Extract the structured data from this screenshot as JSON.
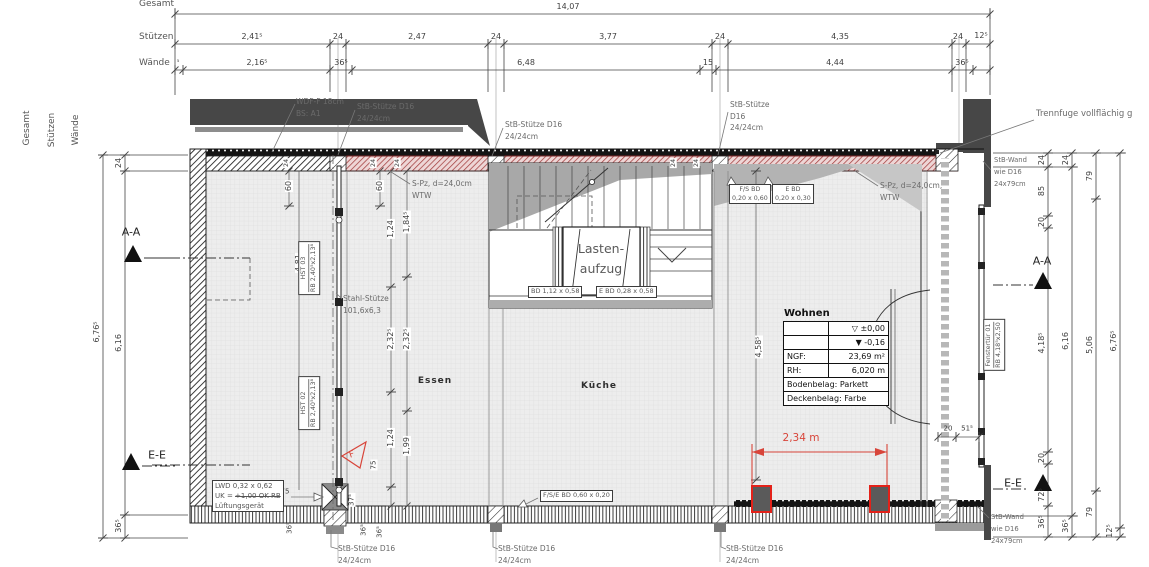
{
  "top_dims": {
    "row_labels": [
      "Gesamt",
      "Stützen",
      "Wände"
    ],
    "total": "14,07",
    "stuetzen": [
      "2,41⁵",
      "24",
      "2,47",
      "24",
      "3,77",
      "24",
      "4,35",
      "24",
      "12⁵"
    ],
    "waende": [
      "⁵",
      "2,16⁵",
      "36⁵",
      "6,48",
      "15",
      "4,44",
      "36⁵"
    ]
  },
  "left_dims": {
    "rotated_labels": [
      "Gesamt",
      "Stützen",
      "Wände"
    ],
    "total": "6,76⁵",
    "inner": [
      "24",
      "6,16",
      "36⁵"
    ],
    "section_aa": "A-A",
    "section_ee": "E-E"
  },
  "right_dims": {
    "chain1": [
      "24",
      "85",
      "20",
      "4,18⁵",
      "20",
      "72⁵",
      "36⁵"
    ],
    "chain2": [
      "24",
      "6,16",
      "36⁵"
    ],
    "chain3": [
      "79",
      "5,06",
      "79"
    ],
    "chain4_total": "6,76⁵",
    "chain4_bottom": "12⁵",
    "section_aa": "A-A",
    "section_ee": "E-E",
    "door_dims": [
      "20",
      "51⁵"
    ]
  },
  "interior_dims": {
    "d60": "60",
    "d124": "1,24",
    "d1845": "1,84⁵",
    "d2325": "2,32⁵",
    "d199": "1,99",
    "d481": "4,81",
    "d4585": "4,58⁵",
    "d75": "75",
    "d375": "37⁵",
    "d365": "36⁵",
    "d24": "24"
  },
  "rooms": {
    "essen": "Essen",
    "kueche": "Küche",
    "lift_line1": "Lasten-",
    "lift_line2": "aufzug"
  },
  "wohnen_table": {
    "title": "Wohnen",
    "level_upper": "▽ ±0,00",
    "level_lower": "▼ -0,16",
    "ngf_label": "NGF:",
    "ngf_value": "23,69 m²",
    "rh_label": "RH:",
    "rh_value": "6,020 m",
    "floor": "Bodenbelag: Parkett",
    "ceiling": "Deckenbelag: Farbe"
  },
  "annotations": {
    "wdf_1": "WDF-F 18cm",
    "wdf_2": "BS: A1",
    "stb_stuetze": "StB-Stütze D16",
    "stb_stuetze_a": "StB-Stütze",
    "stb_stuetze_b": "D16",
    "stb_size": "24/24cm",
    "spz": "S-Pz, d=24,0cm",
    "spz_r": "S-Pz, d=24,0cm,",
    "wtw": "WTW",
    "trennfuge": "Trennfuge vollflächig g",
    "stb_wand_1": "StB-Wand",
    "stb_wand_2": "wie D16",
    "stb_wand_3": "24x79cm",
    "fs_bd_1": "F/S BD",
    "fs_bd_2": "0,20 x 0,60",
    "e_bd_1": "E BD",
    "e_bd_2": "0,20 x 0,30",
    "bd_1": "BD 1,12 x 0,58",
    "bd_2": "E BD 0,28 x 0,58",
    "stahl_1": "Stahl-Stütze",
    "stahl_2": "101,6x6,3",
    "hst03": "HST 03",
    "hst02": "HST 02",
    "hst_rb": "RB 2,40⁵x2,13⁸",
    "lwd_1": "LWD 0,32 x 0,62",
    "lwd_2a": "UK = ",
    "lwd_2b": "+1,00 OK RB",
    "lwd_3": "Lüftungsgerät",
    "fse_bd": "F/S/E BD 0,60 x 0,20",
    "fenster_1": "Fenstertür 01",
    "fenster_2": "RB 4,18⁵x2,50",
    "red_span": "2,34 m",
    "f_marker": "F"
  },
  "colors": {
    "wall_red": "#a33e3e",
    "dim_red": "#d8453a",
    "structure_dark": "#474747"
  }
}
